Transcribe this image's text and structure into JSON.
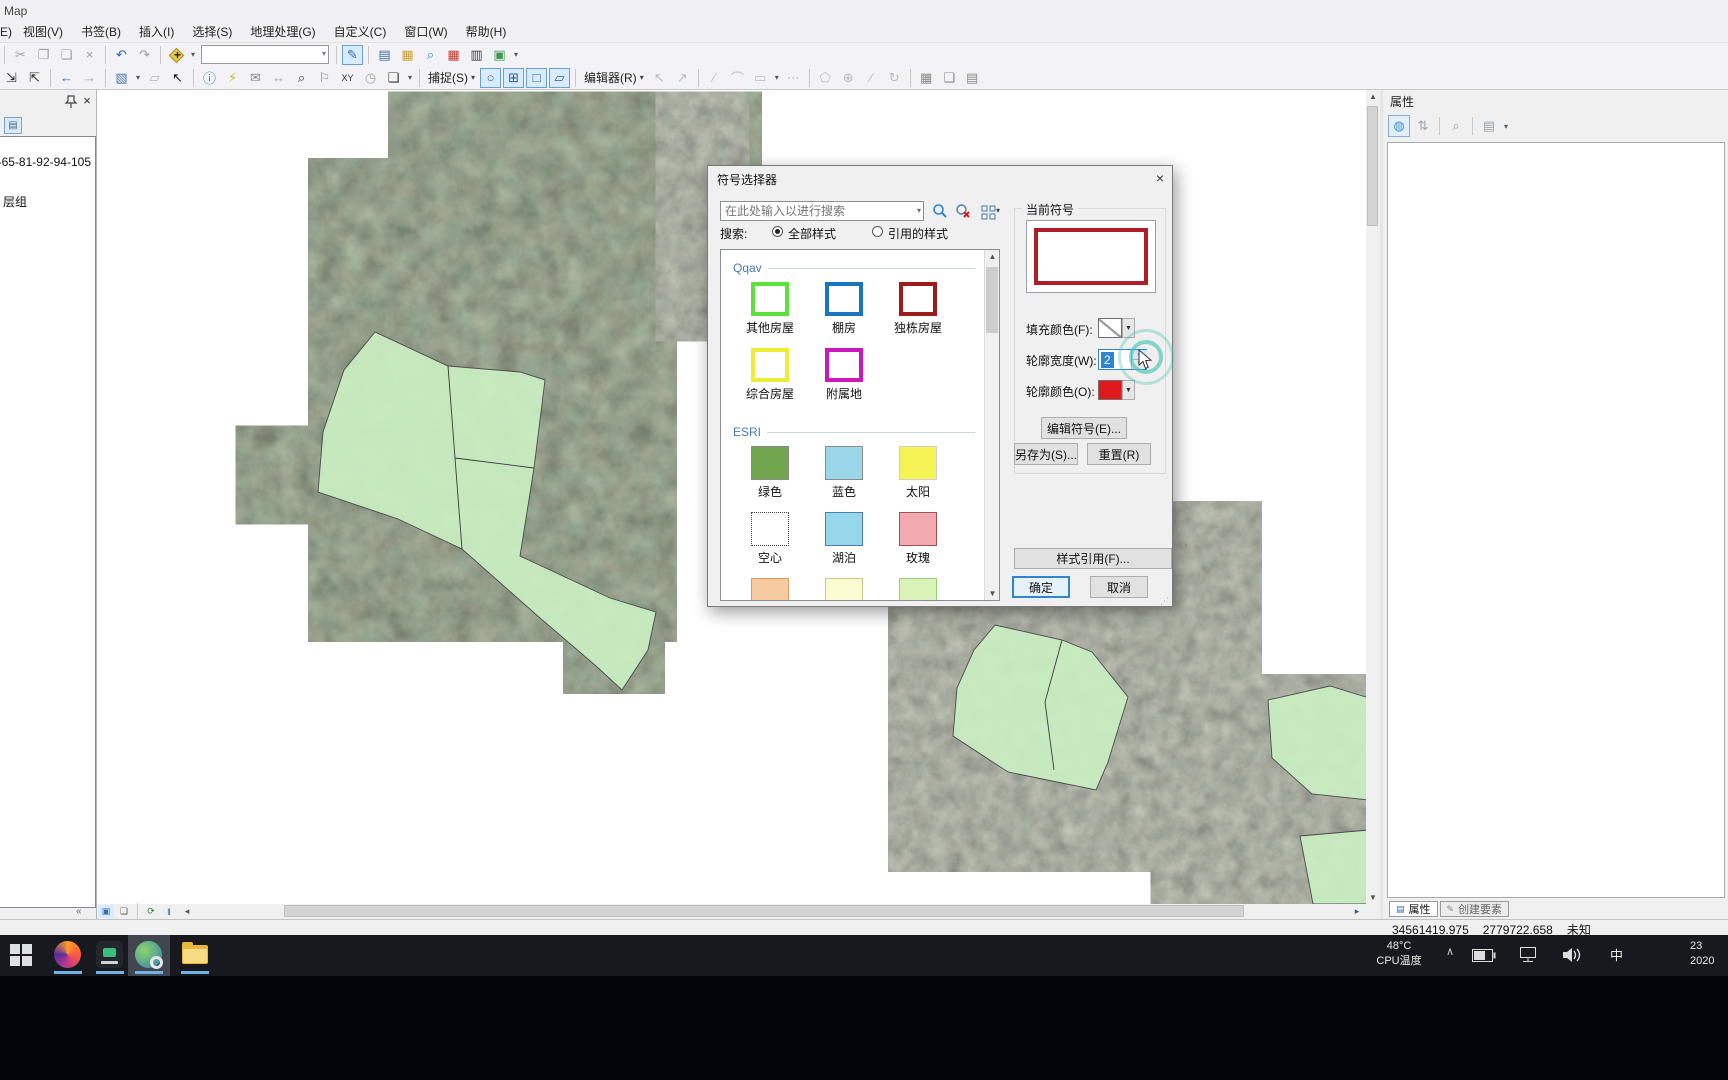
{
  "window": {
    "title": "Map"
  },
  "menu": {
    "items": [
      "E)",
      "视图(V)",
      "书签(B)",
      "插入(I)",
      "选择(S)",
      "地理处理(G)",
      "自定义(C)",
      "窗口(W)",
      "帮助(H)"
    ]
  },
  "toolbar1": {
    "items": [
      {
        "t": "sep"
      },
      {
        "t": "i",
        "n": "cut-icon",
        "g": "✂",
        "c": "#9e9e9e"
      },
      {
        "t": "i",
        "n": "copy-icon",
        "g": "❐",
        "c": "#9e9e9e"
      },
      {
        "t": "i",
        "n": "paste-icon",
        "g": "❏",
        "c": "#9e9e9e"
      },
      {
        "t": "i",
        "n": "delete-icon",
        "g": "×",
        "c": "#9e9e9e"
      },
      {
        "t": "sep"
      },
      {
        "t": "i",
        "n": "undo-icon",
        "g": "↶",
        "c": "#2b62c2"
      },
      {
        "t": "i",
        "n": "redo-icon",
        "g": "↷",
        "c": "#9e9e9e"
      },
      {
        "t": "sep"
      },
      {
        "t": "diamond",
        "n": "add-data-icon"
      },
      {
        "t": "dd",
        "n": "add-data-dropdown"
      },
      {
        "t": "combo",
        "n": "map-scale-combo"
      },
      {
        "t": "sep"
      },
      {
        "t": "i",
        "n": "edit-sketch-icon",
        "g": "✎",
        "c": "#2b62c2",
        "active": true
      },
      {
        "t": "sep"
      },
      {
        "t": "i",
        "n": "table-of-contents-icon",
        "g": "▤",
        "c": "#3a6ea5"
      },
      {
        "t": "i",
        "n": "catalog-icon",
        "g": "▦",
        "c": "#c8a23c"
      },
      {
        "t": "i",
        "n": "search-window-icon",
        "g": "⌕",
        "c": "#2b80c4"
      },
      {
        "t": "i",
        "n": "arctoolbox-icon",
        "g": "▦",
        "c": "#c03a2e"
      },
      {
        "t": "i",
        "n": "python-window-icon",
        "g": "▥",
        "c": "#3a3f4a"
      },
      {
        "t": "i",
        "n": "modelbuilder-icon",
        "g": "▣",
        "c": "#3f9b4f"
      },
      {
        "t": "dd",
        "n": "toolbar-overflow-dropdown"
      }
    ]
  },
  "toolbar2": {
    "items": [
      {
        "t": "i",
        "n": "fixed-zoom-in-icon",
        "g": "⇲",
        "c": "#333333"
      },
      {
        "t": "i",
        "n": "fixed-zoom-out-icon",
        "g": "⇱",
        "c": "#333333"
      },
      {
        "t": "sep"
      },
      {
        "t": "i",
        "n": "go-back-extent-icon",
        "g": "←",
        "c": "#2b62c2"
      },
      {
        "t": "i",
        "n": "go-forward-extent-icon",
        "g": "→",
        "c": "#a8a8a8"
      },
      {
        "t": "sep"
      },
      {
        "t": "i",
        "n": "select-features-icon",
        "g": "▧",
        "c": "#4a7ab0"
      },
      {
        "t": "dd",
        "n": "select-features-dropdown"
      },
      {
        "t": "i",
        "n": "clear-selection-icon",
        "g": "▱",
        "c": "#b5b5b5"
      },
      {
        "t": "i",
        "n": "select-elements-icon",
        "g": "↖",
        "c": "#111111"
      },
      {
        "t": "sep"
      },
      {
        "t": "i",
        "n": "identify-icon",
        "g": "ⓘ",
        "c": "#2277cc"
      },
      {
        "t": "i",
        "n": "hyperlink-icon",
        "g": "⚡",
        "c": "#c2bd3a"
      },
      {
        "t": "i",
        "n": "html-popup-icon",
        "g": "✉",
        "c": "#8a8a8a"
      },
      {
        "t": "i",
        "n": "measure-icon",
        "g": "↔",
        "c": "#a8a8a8"
      },
      {
        "t": "i",
        "n": "find-icon",
        "g": "⌕",
        "c": "#333333"
      },
      {
        "t": "i",
        "n": "find-route-icon",
        "g": "⚐",
        "c": "#8a8a8a"
      },
      {
        "t": "i",
        "n": "go-to-xy-icon",
        "g": "XY",
        "c": "#333333",
        "small": true
      },
      {
        "t": "i",
        "n": "time-slider-icon",
        "g": "◷",
        "c": "#a8a8a8"
      },
      {
        "t": "i",
        "n": "viewer-window-icon",
        "g": "❏",
        "c": "#333333"
      },
      {
        "t": "dd",
        "n": "toolbar-overflow-dropdown"
      },
      {
        "t": "sep"
      },
      {
        "t": "label",
        "n": "snapping-menu",
        "text": "捕捉(S)"
      },
      {
        "t": "i",
        "n": "snap-point-icon",
        "g": "○",
        "c": "#2a5b8c",
        "toggle": true
      },
      {
        "t": "i",
        "n": "snap-end-icon",
        "g": "⊞",
        "c": "#2a5b8c",
        "toggle": true
      },
      {
        "t": "i",
        "n": "snap-vertex-icon",
        "g": "□",
        "c": "#2a5b8c",
        "toggle": true
      },
      {
        "t": "i",
        "n": "snap-edge-icon",
        "g": "▱",
        "c": "#2a5b8c",
        "toggle": true
      },
      {
        "t": "sep"
      },
      {
        "t": "label",
        "n": "editor-menu",
        "text": "编辑器(R)"
      },
      {
        "t": "i",
        "n": "edit-tool-icon",
        "g": "↖",
        "c": "#bcbcbc"
      },
      {
        "t": "i",
        "n": "edit-annotation-icon",
        "g": "↗",
        "c": "#bcbcbc"
      },
      {
        "t": "sep"
      },
      {
        "t": "i",
        "n": "straight-segment-icon",
        "g": "∕",
        "c": "#bcbcbc"
      },
      {
        "t": "i",
        "n": "endpoint-arc-icon",
        "g": "⌒",
        "c": "#bcbcbc"
      },
      {
        "t": "i",
        "n": "trace-icon",
        "g": "▭",
        "c": "#bcbcbc"
      },
      {
        "t": "dd",
        "n": "construction-dropdown"
      },
      {
        "t": "i",
        "n": "point-icon",
        "g": "⋯",
        "c": "#bcbcbc"
      },
      {
        "t": "sep"
      },
      {
        "t": "i",
        "n": "reshape-icon",
        "g": "⬠",
        "c": "#bcbcbc"
      },
      {
        "t": "i",
        "n": "cut-polygons-icon",
        "g": "⊕",
        "c": "#bcbcbc"
      },
      {
        "t": "i",
        "n": "split-icon",
        "g": "∕",
        "c": "#bcbcbc"
      },
      {
        "t": "i",
        "n": "rotate-icon",
        "g": "↻",
        "c": "#bcbcbc"
      },
      {
        "t": "sep"
      },
      {
        "t": "i",
        "n": "create-features-window-icon",
        "g": "▦",
        "c": "#8a8a8a"
      },
      {
        "t": "i",
        "n": "attributes-window-icon",
        "g": "❏",
        "c": "#8a8a8a"
      },
      {
        "t": "i",
        "n": "sketch-properties-icon",
        "g": "▤",
        "c": "#8a8a8a"
      }
    ]
  },
  "mapbar": {
    "items": [
      {
        "t": "i",
        "n": "data-view-button",
        "g": "▣",
        "c": "#3a6ea5",
        "toggle": true
      },
      {
        "t": "i",
        "n": "layout-view-button",
        "g": "❏",
        "c": "#555555"
      },
      {
        "t": "sep"
      },
      {
        "t": "i",
        "n": "refresh-view-icon",
        "g": "⟳",
        "c": "#2a7a3a"
      },
      {
        "t": "i",
        "n": "pause-drawing-icon",
        "g": "‖",
        "c": "#2a5b8c"
      },
      {
        "t": "i",
        "n": "scroll-left-icon",
        "g": "◂",
        "c": "#555555"
      }
    ]
  },
  "toc": {
    "layer_text": "-65-81-92-94-105",
    "group_text": "层组"
  },
  "dialog": {
    "title": "符号选择器",
    "search_placeholder": "在此处输入以进行搜索",
    "search_label": "搜索:",
    "radio_all": "全部样式",
    "radio_referenced": "引用的样式",
    "groups": [
      {
        "name": "Qqav",
        "items": [
          {
            "label": "其他房屋",
            "fill": "#ffffff",
            "border": "#5ce13a",
            "bw": 4
          },
          {
            "label": "棚房",
            "fill": "#ffffff",
            "border": "#1b75bc",
            "bw": 4
          },
          {
            "label": "独栋房屋",
            "fill": "#ffffff",
            "border": "#9e1b1b",
            "bw": 4
          },
          {
            "label": "综合房屋",
            "fill": "#ffffff",
            "border": "#efec38",
            "bw": 4
          },
          {
            "label": "附属地",
            "fill": "#ffffff",
            "border": "#cc17c0",
            "bw": 4
          }
        ]
      },
      {
        "name": "ESRI",
        "items": [
          {
            "label": "绿色",
            "fill": "#72a64e",
            "border": "#8a8a8a",
            "bw": 1
          },
          {
            "label": "蓝色",
            "fill": "#9bd7e9",
            "border": "#8a8a8a",
            "bw": 1
          },
          {
            "label": "太阳",
            "fill": "#f4f355",
            "border": "#cfcfcf",
            "bw": 1
          },
          {
            "label": "空心",
            "fill": "#ffffff",
            "border": "#444444",
            "bw": 1,
            "dotted": true
          },
          {
            "label": "湖泊",
            "fill": "#97d7ec",
            "border": "#4a7eb0",
            "bw": 1
          },
          {
            "label": "玫瑰",
            "fill": "#f2a9b0",
            "border": "#a05050",
            "bw": 1
          },
          {
            "label": "",
            "fill": "#f6cba1",
            "border": "#d89a60",
            "bw": 1
          },
          {
            "label": "",
            "fill": "#fbfbd2",
            "border": "#cccc88",
            "bw": 1
          },
          {
            "label": "",
            "fill": "#d8f2b8",
            "border": "#99cc77",
            "bw": 1
          }
        ]
      }
    ],
    "current": {
      "label": "当前符号",
      "outline_color": "#b01d28"
    },
    "fields": {
      "fill_label": "填充颜色(F):",
      "width_label": "轮廓宽度(W):",
      "width_value": "2",
      "outline_label": "轮廓颜色(O):",
      "outline_swatch": "#e0191f"
    },
    "buttons": {
      "edit": "编辑符号(E)...",
      "save_as": "另存为(S)...",
      "reset": "重置(R)",
      "style_refs": "样式引用(F)...",
      "ok": "确定",
      "cancel": "取消"
    }
  },
  "right_panel": {
    "title": "属性",
    "tab_attributes": "属性",
    "tab_create": "创建要素"
  },
  "statusbar": {
    "x": "34561419.975",
    "y": "2779722.658",
    "units": "未知"
  },
  "taskbar": {
    "temp": "48°C",
    "temp_label": "CPU温度",
    "ime": "中",
    "time": "23",
    "date": "2020"
  }
}
